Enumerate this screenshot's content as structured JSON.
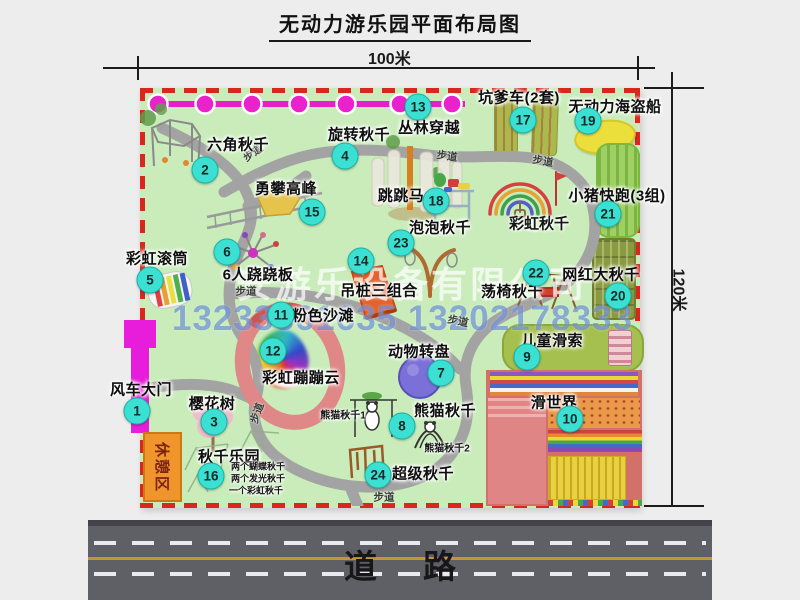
{
  "title": "无动力游乐园平面布局图",
  "dims": {
    "top": "100米",
    "right": "120米"
  },
  "watermark": {
    "company": "安游乐设备有限公司",
    "phone": "13233861635 13202178333"
  },
  "road": {
    "label": "道路"
  },
  "rest_area": {
    "label": "休憩区"
  },
  "trail_label": "步道",
  "trails": [
    {
      "x": 253,
      "y": 153,
      "r": -35
    },
    {
      "x": 447,
      "y": 156,
      "r": 8
    },
    {
      "x": 543,
      "y": 161,
      "r": 10
    },
    {
      "x": 246,
      "y": 291,
      "r": 0
    },
    {
      "x": 458,
      "y": 321,
      "r": 12
    },
    {
      "x": 257,
      "y": 413,
      "r": -70
    },
    {
      "x": 384,
      "y": 497,
      "r": 0
    }
  ],
  "attractions": [
    {
      "num": "1",
      "name": "风车大门",
      "bx": 137,
      "by": 411,
      "lx": 141,
      "ly": 389
    },
    {
      "num": "2",
      "name": "六角秋千",
      "bx": 205,
      "by": 170,
      "lx": 238,
      "ly": 144
    },
    {
      "num": "3",
      "name": "樱花树",
      "bx": 214,
      "by": 422,
      "lx": 212,
      "ly": 403
    },
    {
      "num": "4",
      "name": "旋转秋千",
      "bx": 345,
      "by": 156,
      "lx": 359,
      "ly": 134
    },
    {
      "num": "5",
      "name": "彩虹滚筒",
      "bx": 150,
      "by": 280,
      "lx": 157,
      "ly": 258
    },
    {
      "num": "6",
      "name": "6人跷跷板",
      "bx": 227,
      "by": 252,
      "lx": 258,
      "ly": 274
    },
    {
      "num": "7",
      "name": "动物转盘",
      "bx": 441,
      "by": 373,
      "lx": 419,
      "ly": 351
    },
    {
      "num": "8",
      "name": "熊猫秋千",
      "bx": 402,
      "by": 426,
      "lx": 445,
      "ly": 410
    },
    {
      "num": "9",
      "name": "儿童滑索",
      "bx": 527,
      "by": 357,
      "lx": 552,
      "ly": 340
    },
    {
      "num": "10",
      "name": "滑世界",
      "bx": 570,
      "by": 419,
      "lx": 554,
      "ly": 402
    },
    {
      "num": "11",
      "name": "粉色沙滩",
      "bx": 281,
      "by": 315,
      "lx": 323,
      "ly": 315
    },
    {
      "num": "12",
      "name": "彩虹蹦蹦云",
      "bx": 273,
      "by": 351,
      "lx": 301,
      "ly": 377
    },
    {
      "num": "13",
      "name": "丛林穿越",
      "bx": 418,
      "by": 107,
      "lx": 429,
      "ly": 127
    },
    {
      "num": "14",
      "name": "吊桩三组合",
      "bx": 361,
      "by": 261,
      "lx": 379,
      "ly": 290
    },
    {
      "num": "15",
      "name": "勇攀高峰",
      "bx": 312,
      "by": 212,
      "lx": 286,
      "ly": 188
    },
    {
      "num": "16",
      "name": "秋千乐园",
      "bx": 211,
      "by": 476,
      "lx": 229,
      "ly": 456
    },
    {
      "num": "17",
      "name": "坑爹车(2套)",
      "bx": 523,
      "by": 120,
      "lx": 519,
      "ly": 97
    },
    {
      "num": "18",
      "name": "跳跳马",
      "bx": 436,
      "by": 201,
      "lx": 401,
      "ly": 195
    },
    {
      "num": "19",
      "name": "无动力海盗船",
      "bx": 588,
      "by": 121,
      "lx": 615,
      "ly": 106
    },
    {
      "num": "20",
      "name": "网红大秋千",
      "bx": 618,
      "by": 296,
      "lx": 601,
      "ly": 274
    },
    {
      "num": "21",
      "name": "小猪快跑(3组)",
      "bx": 608,
      "by": 214,
      "lx": 617,
      "ly": 195
    },
    {
      "num": "22",
      "name": "荡椅秋千",
      "bx": 536,
      "by": 273,
      "lx": 512,
      "ly": 291
    },
    {
      "num": "23",
      "name": "泡泡秋千",
      "bx": 401,
      "by": 243,
      "lx": 440,
      "ly": 227
    },
    {
      "num": "24",
      "name": "超级秋千",
      "bx": 378,
      "by": 475,
      "lx": 423,
      "ly": 473
    }
  ],
  "annotations": [
    {
      "text": "彩虹秋千",
      "x": 539,
      "y": 223,
      "fs": 15,
      "w": 700
    },
    {
      "text": "熊猫秋千1",
      "x": 343,
      "y": 414,
      "fs": 10,
      "w": 700
    },
    {
      "text": "熊猫秋千2",
      "x": 447,
      "y": 447,
      "fs": 10,
      "w": 700
    },
    {
      "text": "两个蝴蝶秋千",
      "x": 258,
      "y": 466,
      "fs": 9,
      "w": 600
    },
    {
      "text": "两个发光秋千",
      "x": 258,
      "y": 478,
      "fs": 9,
      "w": 600
    },
    {
      "text": "一个彩虹秋千",
      "x": 256,
      "y": 490,
      "fs": 9,
      "w": 600
    }
  ]
}
